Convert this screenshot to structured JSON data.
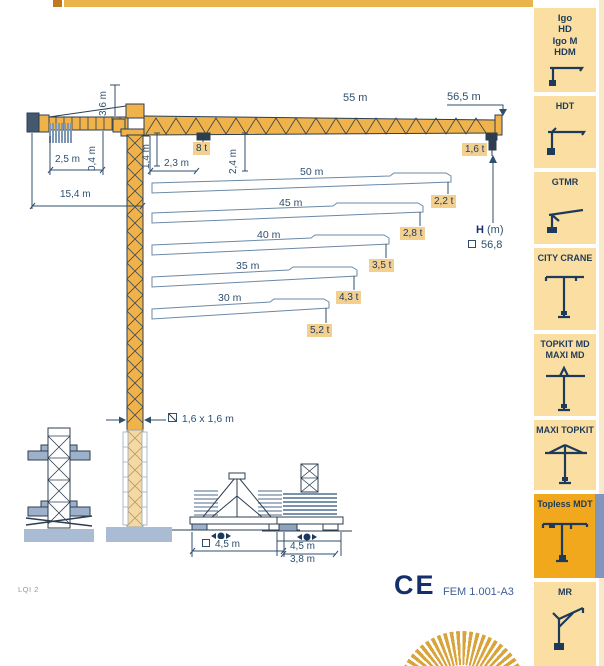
{
  "sidebar": {
    "items": [
      {
        "label": "Igo\nHD\nIgo M\nHDM",
        "icon": "igo-crane-icon",
        "highlighted": false
      },
      {
        "label": "HDT",
        "icon": "hdt-crane-icon",
        "highlighted": false
      },
      {
        "label": "GTMR",
        "icon": "gtmr-crane-icon",
        "highlighted": false
      },
      {
        "label": "CITY CRANE",
        "icon": "city-crane-icon",
        "highlighted": false
      },
      {
        "label": "TOPKIT MD\nMAXI MD",
        "icon": "topkit-md-crane-icon",
        "highlighted": false
      },
      {
        "label": "MAXI TOPKIT",
        "icon": "maxi-topkit-crane-icon",
        "highlighted": false
      },
      {
        "label": "Topless MDT",
        "icon": "topless-mdt-crane-icon",
        "highlighted": true
      },
      {
        "label": "MR",
        "icon": "mr-crane-icon",
        "highlighted": false
      }
    ]
  },
  "diagram": {
    "jib": {
      "total": "55 m",
      "tip": "56,5 m"
    },
    "loads": {
      "max": "8 t",
      "tip": "1,6 t"
    },
    "dims": {
      "tower_head": "3,6 m",
      "counterweight_radius": "2,5 m",
      "gap": "0,4 m",
      "jib_depth": "1,4 m",
      "min_radius": "2,3 m",
      "hook_drop": "2,4 m",
      "counterjib_radius": "15,4 m"
    },
    "height": {
      "label": "H",
      "unit": "(m)",
      "value": "56,8"
    },
    "mast": {
      "section": "1,6 x 1,6 m"
    },
    "jib_rows": [
      {
        "length": "50 m",
        "load": "2,2 t"
      },
      {
        "length": "45 m",
        "load": "2,8 t"
      },
      {
        "length": "40 m",
        "load": "3,5 t"
      },
      {
        "length": "35 m",
        "load": "4,3 t"
      },
      {
        "length": "30 m",
        "load": "5,2 t"
      }
    ],
    "bases": {
      "cross": "4,5 m",
      "static_upper": "4,5 m",
      "static_lower": "3,8 m"
    }
  },
  "footer": {
    "model": "LQI 2",
    "ce": "CE",
    "standard": "FEM 1.001-A3"
  },
  "colors": {
    "crane_yellow": "#f0b24a",
    "accent_orange": "#f2a81c",
    "sidebar_peach": "#fbdfa2",
    "label_amber": "#f3cf90",
    "line_navy": "#2f4f6e",
    "steel_blue": "#a9bcd4"
  }
}
